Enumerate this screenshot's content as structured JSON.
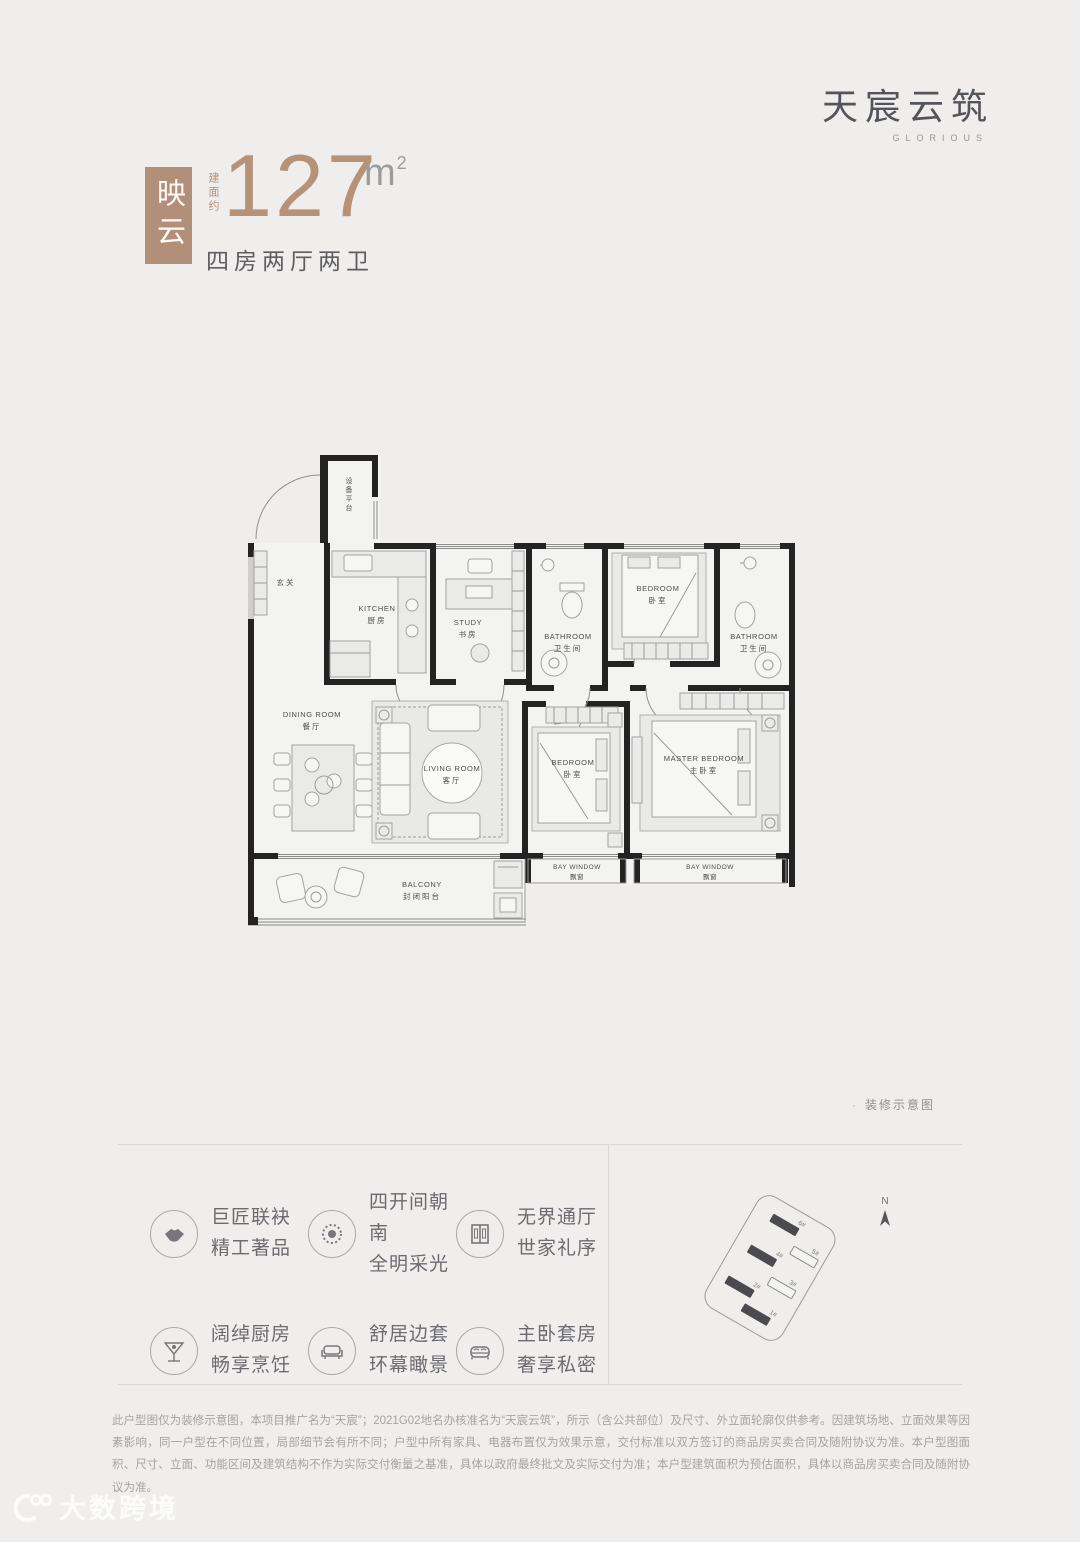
{
  "brand": {
    "logo_cn": "天宸云筑",
    "logo_en": "GLORIOUS"
  },
  "hero": {
    "unit_name": "映云",
    "area_prefix": "建面约",
    "area_value": "127",
    "area_unit": "m",
    "area_sup": "2",
    "layout": "四房两厅两卫",
    "accent_color": "#b28f79"
  },
  "floorplan": {
    "caption_bullet": "·",
    "caption": "装修示意图",
    "entry": "玄关",
    "shaft": "设备平台",
    "rooms": {
      "kitchen": {
        "en": "KITCHEN",
        "cn": "厨房"
      },
      "study": {
        "en": "STUDY",
        "cn": "书房"
      },
      "bath1": {
        "en": "BATHROOM",
        "cn": "卫生间"
      },
      "bed_top": {
        "en": "BEDROOM",
        "cn": "卧室"
      },
      "bath2": {
        "en": "BATHROOM",
        "cn": "卫生间"
      },
      "dining": {
        "en": "DINING ROOM",
        "cn": "餐厅"
      },
      "living": {
        "en": "LIVING ROOM",
        "cn": "客厅"
      },
      "bed_mid": {
        "en": "BEDROOM",
        "cn": "卧室"
      },
      "master": {
        "en": "MASTER BEDROOM",
        "cn": "主卧室"
      },
      "bay1": {
        "en": "BAY WINDOW",
        "cn": "飘窗"
      },
      "bay2": {
        "en": "BAY WINDOW",
        "cn": "飘窗"
      },
      "balcony": {
        "en": "BALCONY",
        "cn": "封闭阳台"
      }
    }
  },
  "features": {
    "items": [
      {
        "icon": "handshake-icon",
        "line1": "巨匠联袂",
        "line2": "精工著品"
      },
      {
        "icon": "sun-icon",
        "line1": "四开间朝南",
        "line2": "全明采光"
      },
      {
        "icon": "door-icon",
        "line1": "无界通厅",
        "line2": "世家礼序"
      },
      {
        "icon": "glass-icon",
        "line1": "阔绰厨房",
        "line2": "畅享烹饪"
      },
      {
        "icon": "sofa-icon",
        "line1": "舒居边套",
        "line2": "环幕瞰景"
      },
      {
        "icon": "bed-icon",
        "line1": "主卧套房",
        "line2": "奢享私密"
      }
    ]
  },
  "sitemap": {
    "compass": "N",
    "buildings": [
      {
        "label": "6#",
        "filled": true
      },
      {
        "label": "5#",
        "filled": false
      },
      {
        "label": "4#",
        "filled": true
      },
      {
        "label": "3#",
        "filled": false
      },
      {
        "label": "2#",
        "filled": true
      },
      {
        "label": "1#",
        "filled": true
      }
    ]
  },
  "disclaimer": {
    "text": "此户型图仅为装修示意图，本项目推广名为“天宸”；2021G02地名办核准名为“天宸云筑”，所示（含公共部位）及尺寸、外立面轮廓仅供参考。因建筑场地、立面效果等因素影响，同一户型在不同位置，局部细节会有所不同；户型中所有家具、电器布置仅为效果示意，交付标准以双方签订的商品房买卖合同及随附协议为准。本户型图面积、尺寸、立面、功能区间及建筑结构不作为实际交付衡量之基准，具体以政府最终批文及实际交付为准；本户型建筑面积为预估面积，具体以商品房买卖合同及随附协议为准。"
  },
  "watermark": {
    "text": "大数跨境"
  }
}
